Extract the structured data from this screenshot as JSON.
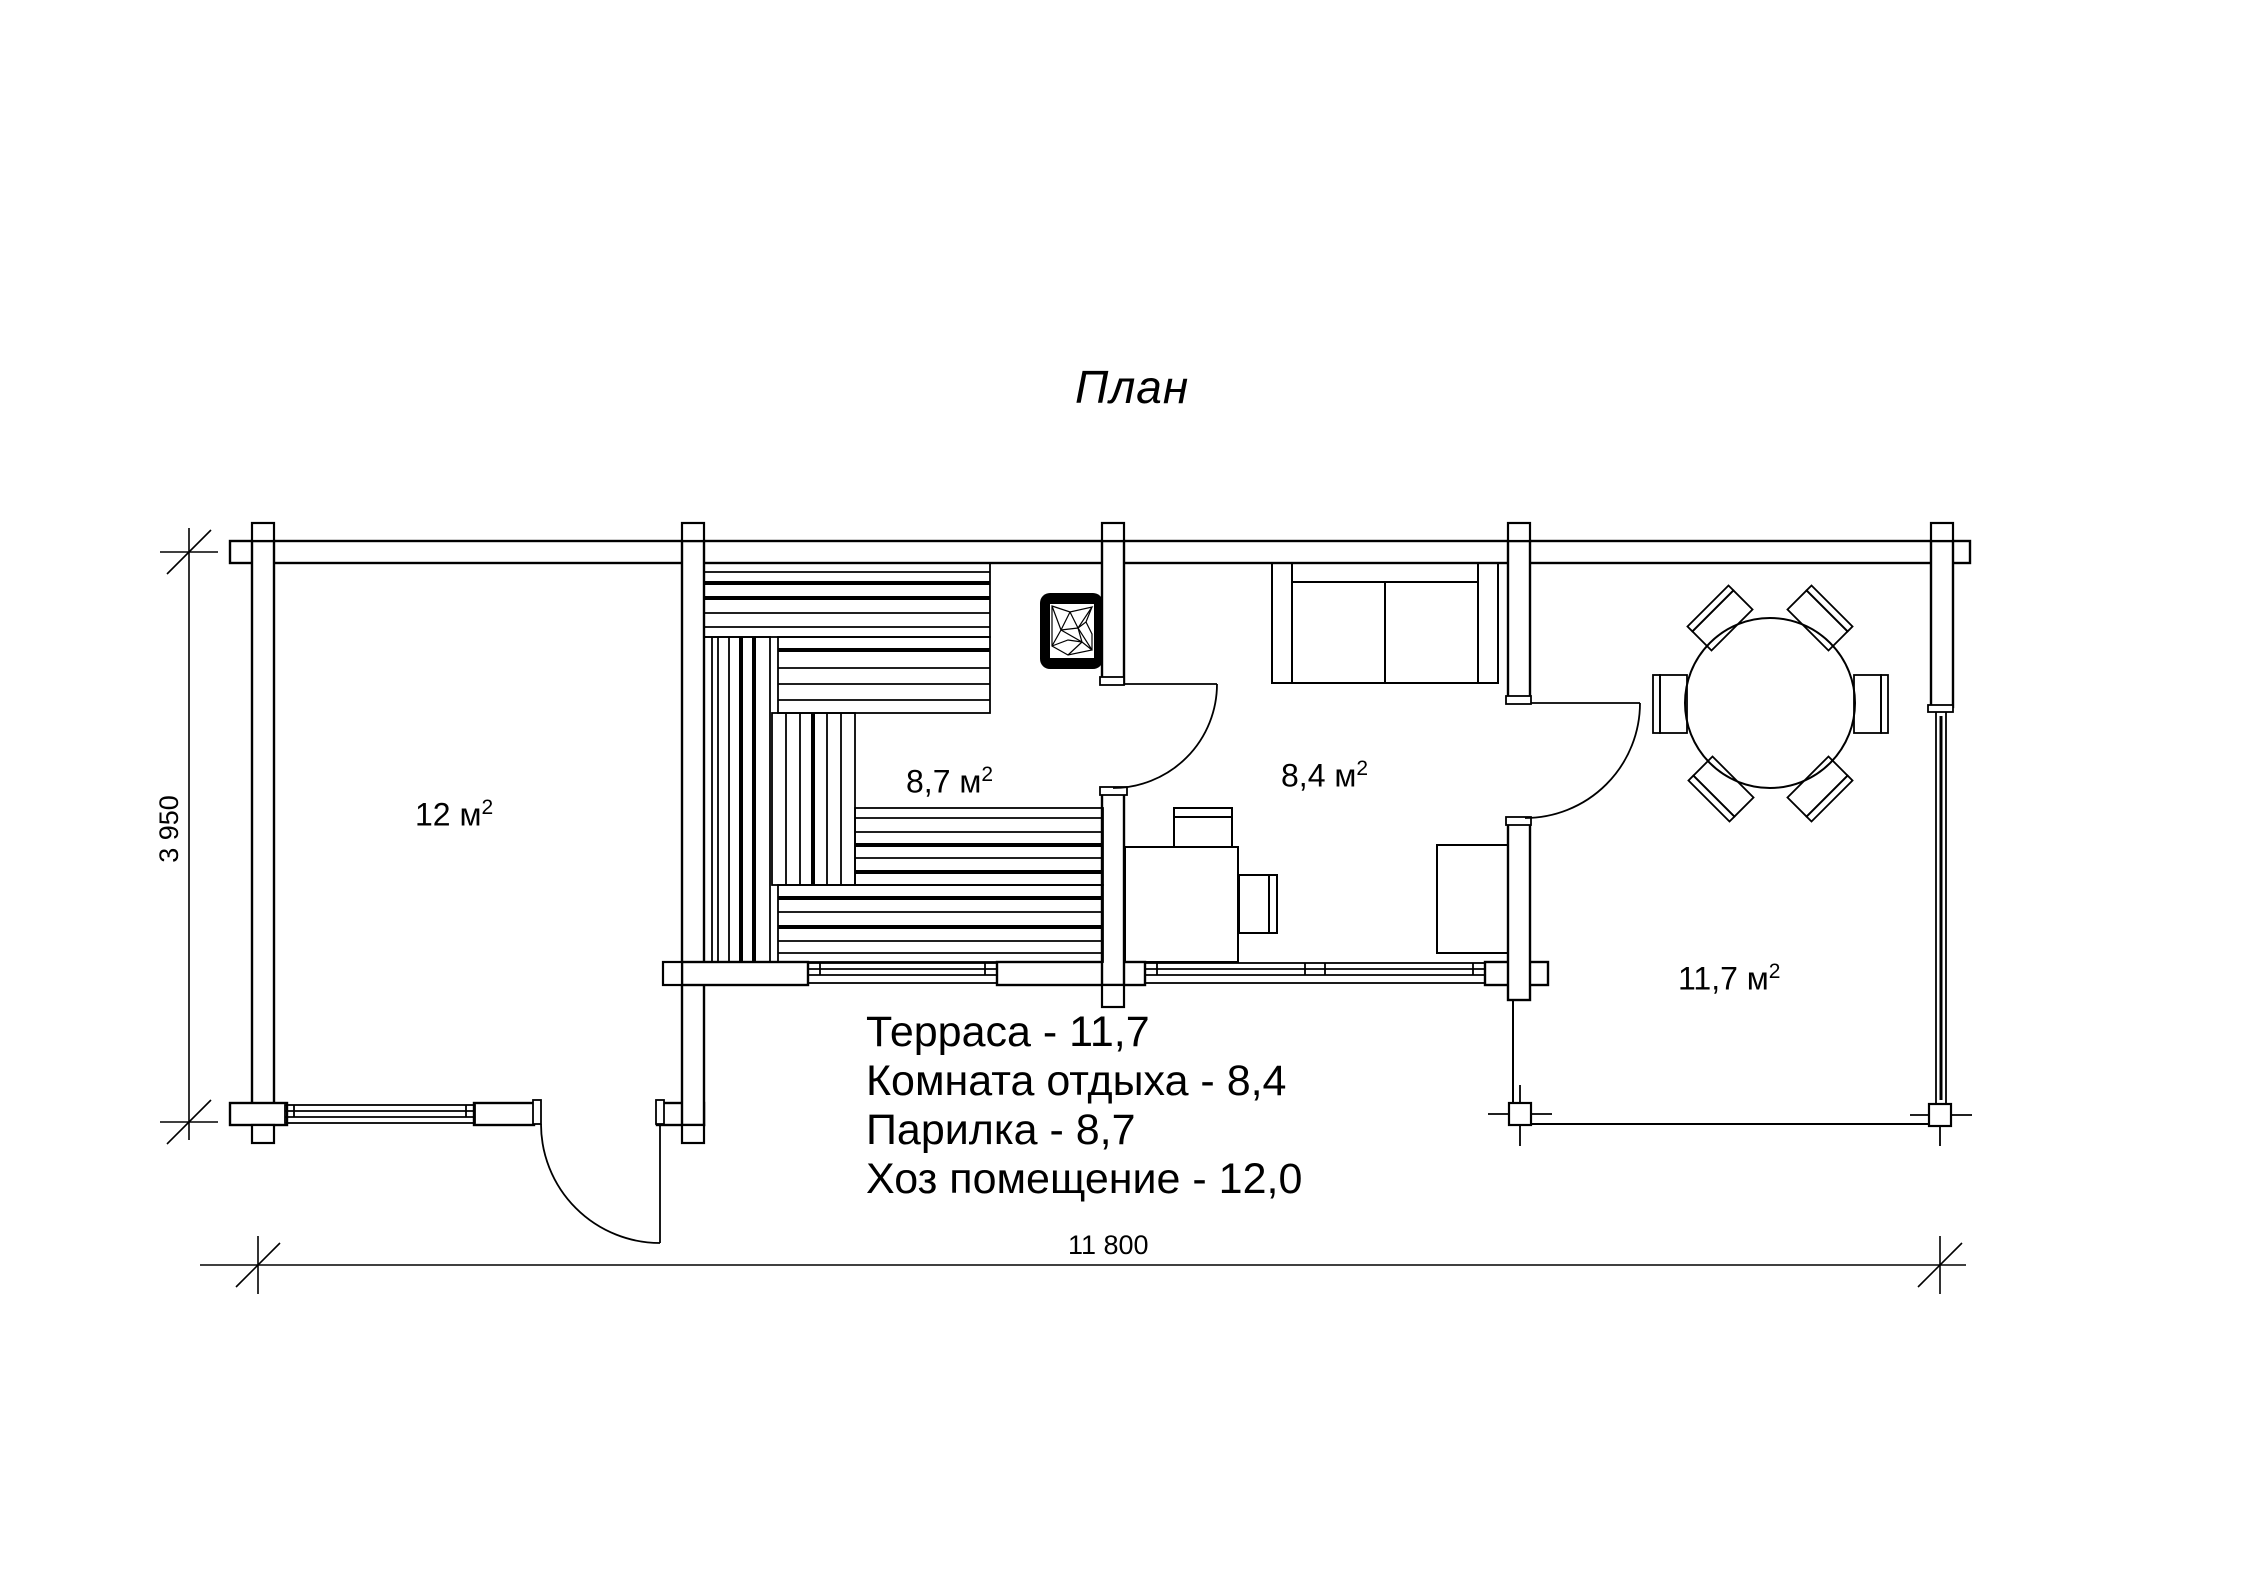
{
  "title": "План",
  "colors": {
    "line": "#000000",
    "background": "#ffffff"
  },
  "rooms": [
    {
      "id": "hoz",
      "area": "12 м",
      "sup": "2"
    },
    {
      "id": "parilka",
      "area": "8,7 м",
      "sup": "2"
    },
    {
      "id": "otdyha",
      "area": "8,4 м",
      "sup": "2"
    },
    {
      "id": "terrasa",
      "area": "11,7 м",
      "sup": "2"
    }
  ],
  "legend": {
    "lines": [
      "Терраса - 11,7",
      "Комната отдыха - 8,4",
      "Парилка - 8,7",
      "Хоз помещение - 12,0"
    ]
  },
  "dimensions": {
    "width_label": "11 800",
    "height_label": "3 950"
  }
}
